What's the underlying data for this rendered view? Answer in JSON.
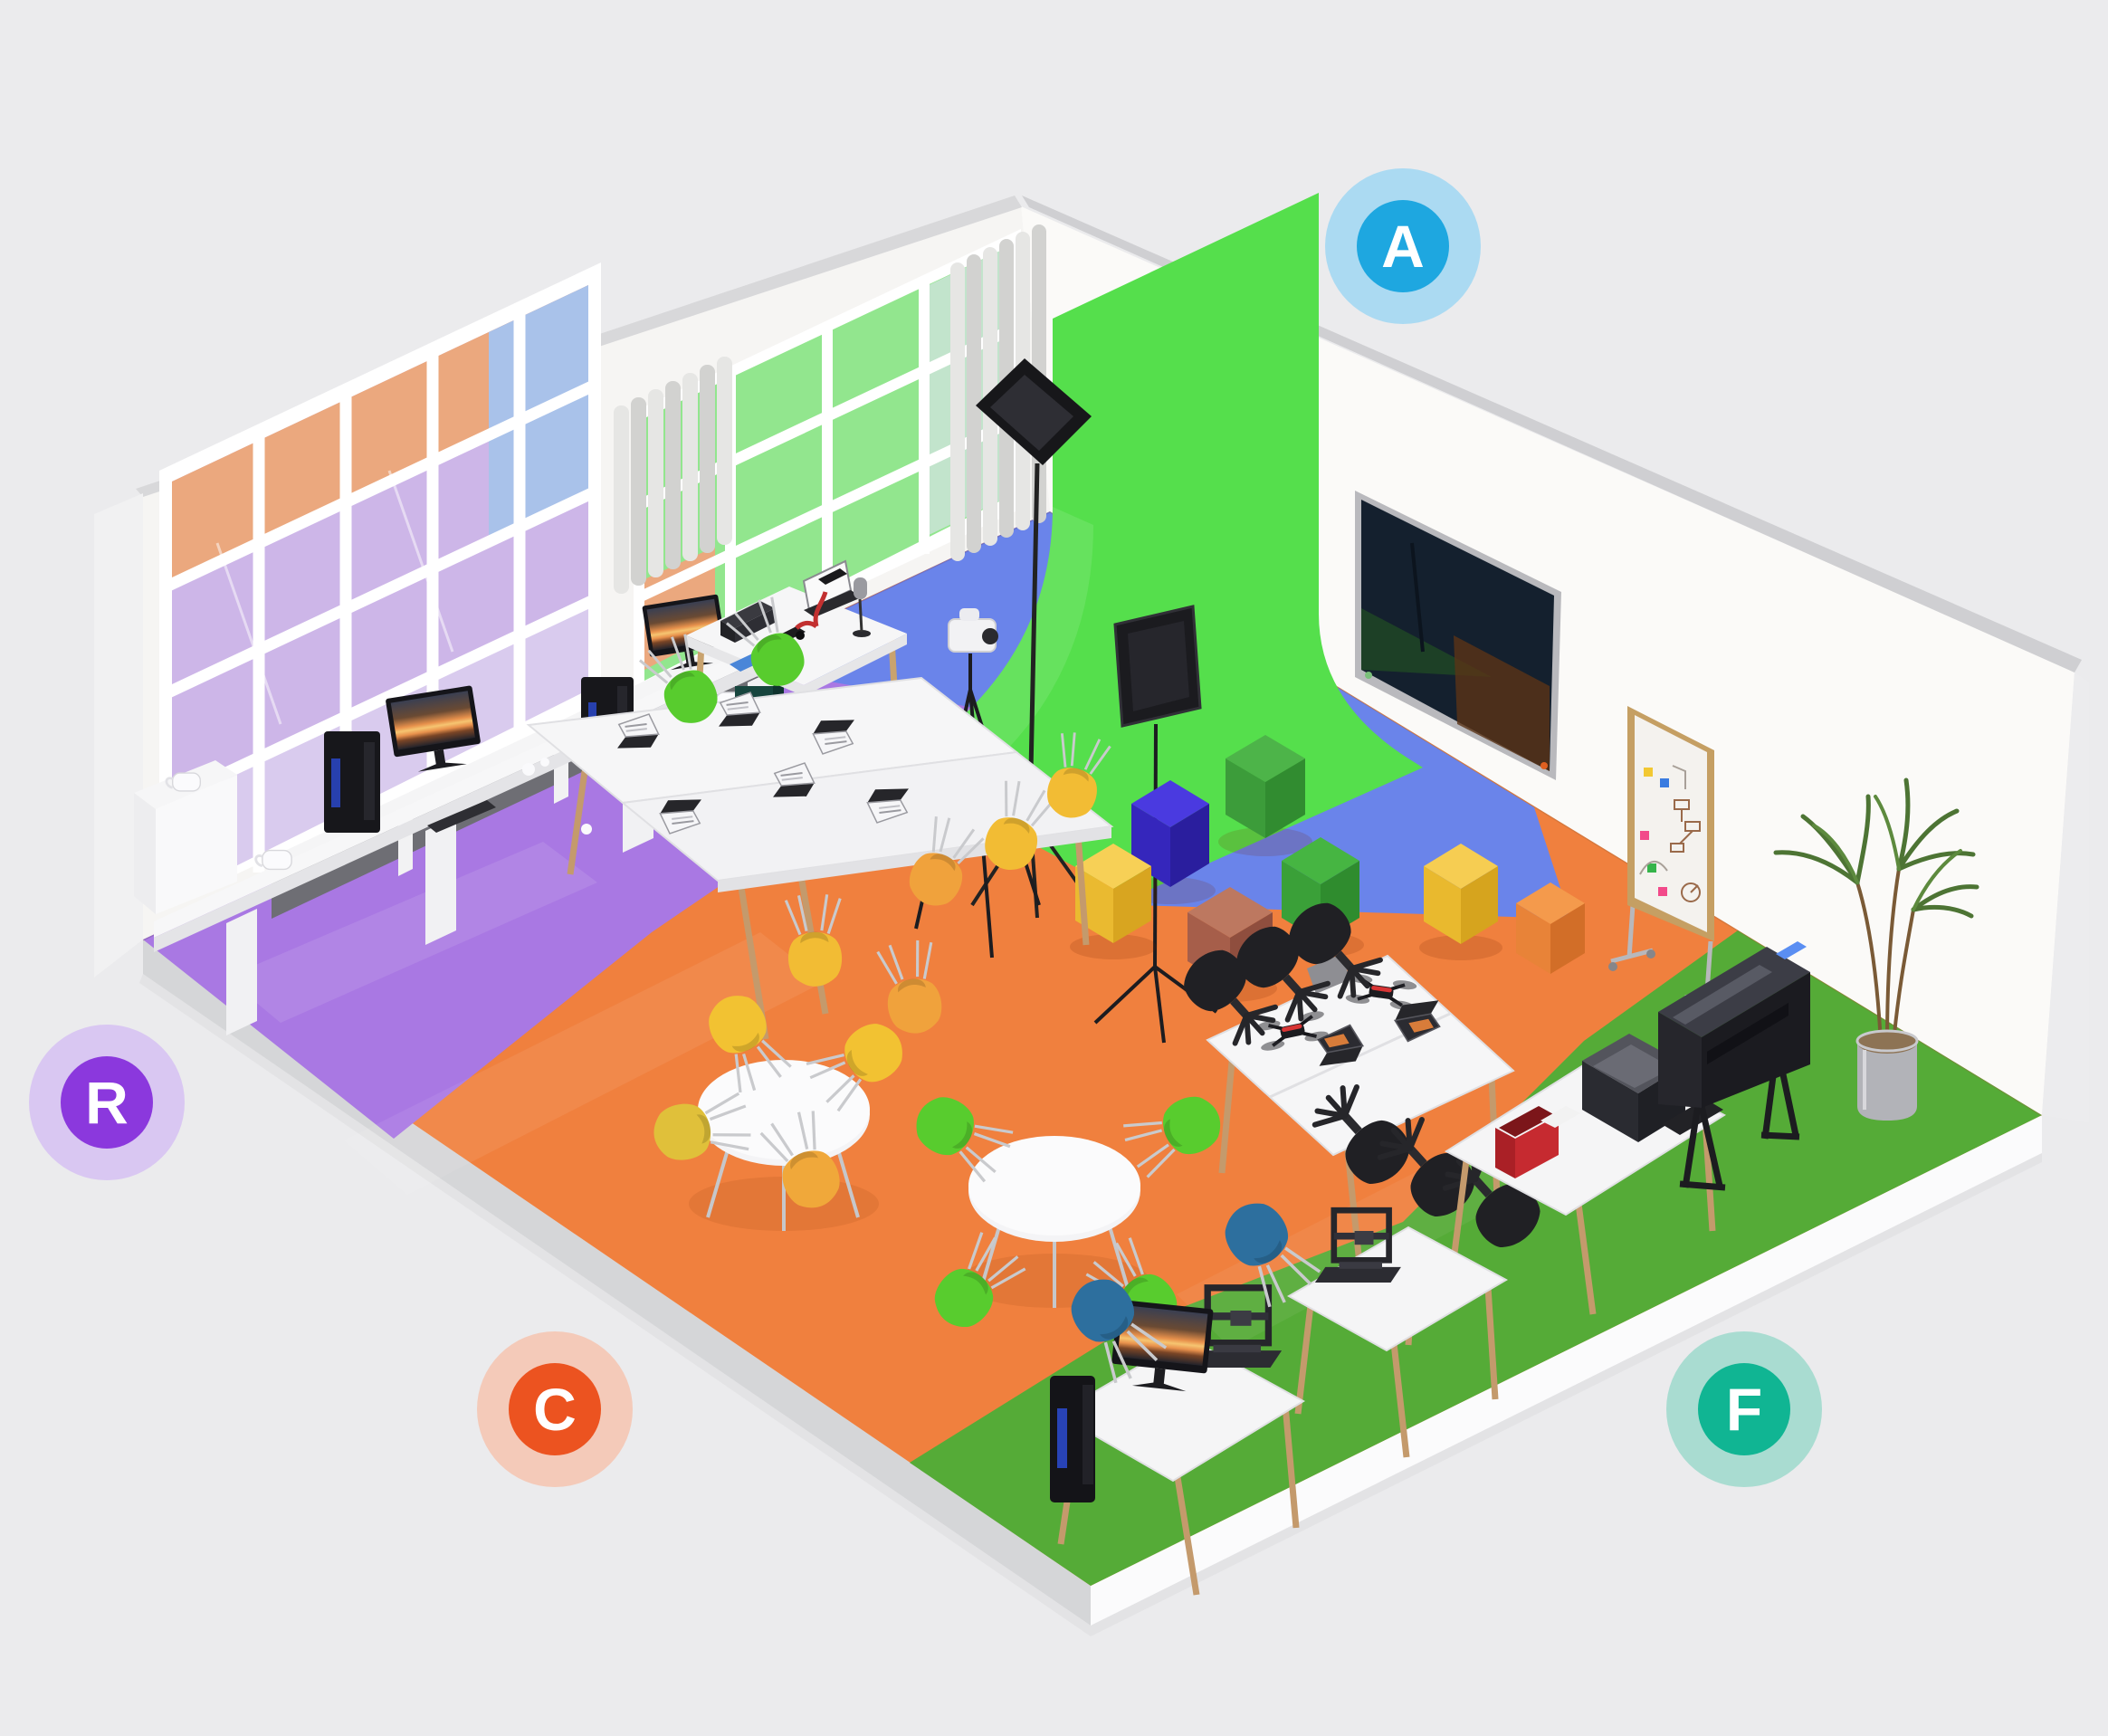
{
  "scene": {
    "background_color": "#ebebed",
    "wall_color": "#f7f6f4",
    "floor_slab_color": "#fafafb"
  },
  "zones": {
    "a": {
      "floor_color": "#6a84ea",
      "green_screen_color": "#55df4c"
    },
    "r": {
      "floor_color": "#a978e3"
    },
    "c": {
      "floor_color": "#f0803e"
    },
    "f": {
      "floor_color": "#55ab37"
    }
  },
  "badges": [
    {
      "letter": "A",
      "inner_color": "#1ea7e0",
      "outer_color": "#abdaf2"
    },
    {
      "letter": "R",
      "inner_color": "#8b38dd",
      "outer_color": "#d9c7f2"
    },
    {
      "letter": "C",
      "inner_color": "#ec5320",
      "outer_color": "#f4cab9"
    },
    {
      "letter": "F",
      "inner_color": "#10b593",
      "outer_color": "#a9dcd1"
    }
  ]
}
